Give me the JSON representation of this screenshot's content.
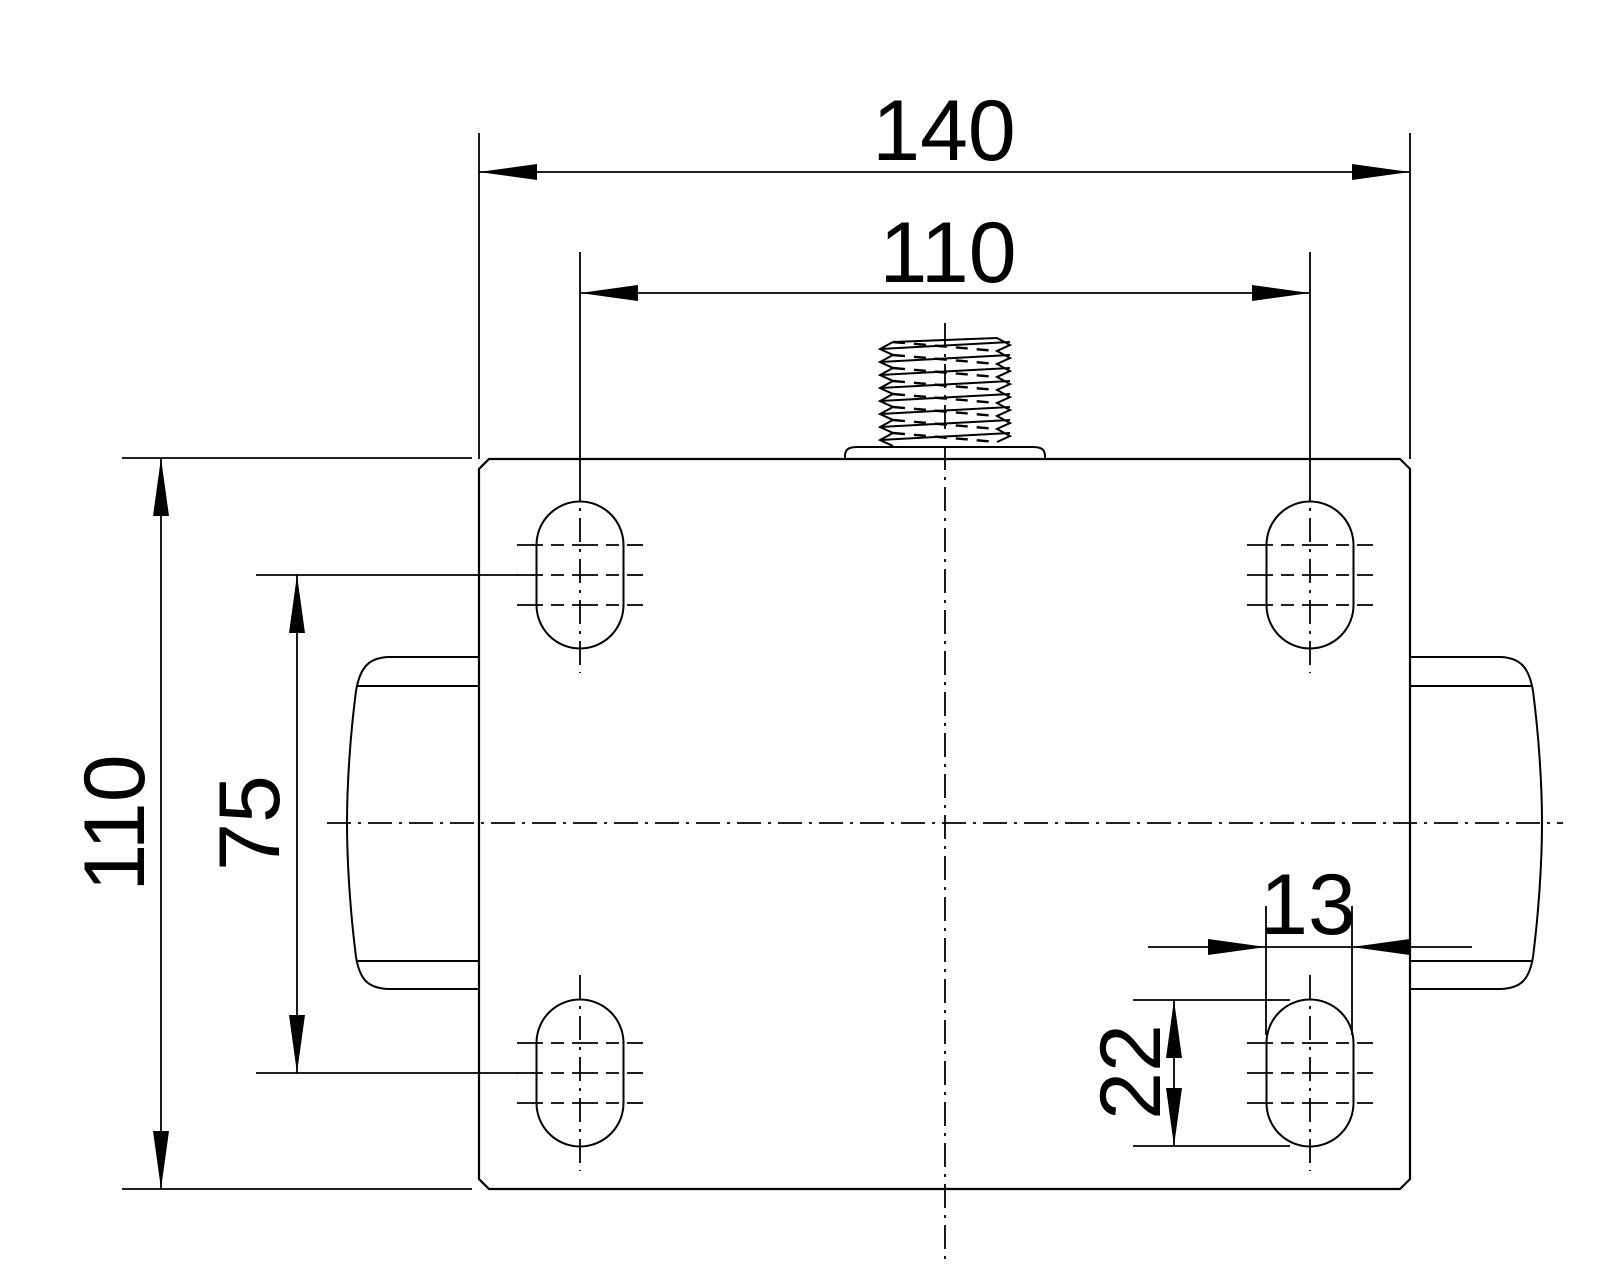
{
  "drawing": {
    "background_color": "#ffffff",
    "line_color": "#000000",
    "dimensions": {
      "plate_width": "140",
      "bolt_hole_spacing_horizontal": "110",
      "plate_depth": "110",
      "bolt_hole_spacing_vertical": "75",
      "slot_width": "13",
      "slot_length": "22"
    }
  }
}
